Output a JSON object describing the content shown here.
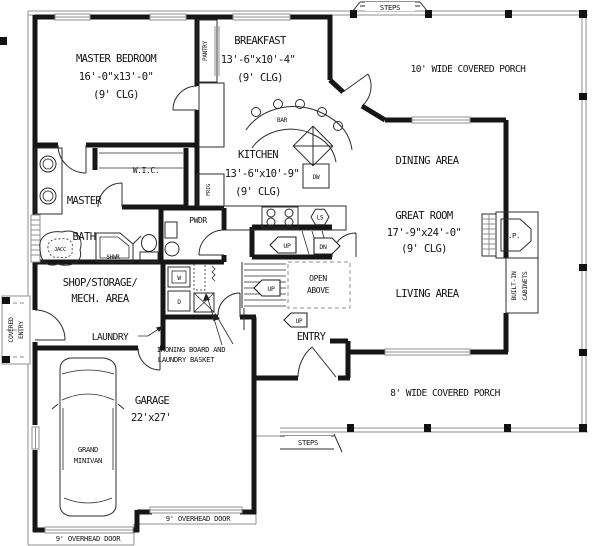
{
  "rooms": {
    "master_bedroom": {
      "name": "MASTER BEDROOM",
      "dims": "16'-0\"x13'-0\"",
      "ceiling": "(9' CLG)"
    },
    "breakfast": {
      "name": "BREAKFAST",
      "dims": "13'-6\"x10'-4\"",
      "ceiling": "(9' CLG)"
    },
    "kitchen": {
      "name": "KITCHEN",
      "dims": "13'-6\"x10'-9\"",
      "ceiling": "(9' CLG)"
    },
    "great_room": {
      "name": "GREAT ROOM",
      "dims": "17'-9\"x24'-0\"",
      "ceiling": "(9' CLG)"
    },
    "dining": {
      "name": "DINING AREA"
    },
    "living": {
      "name": "LIVING AREA"
    },
    "master_bath": {
      "line1": "MASTER",
      "line2": "BATH"
    },
    "wic": {
      "name": "W.I.C."
    },
    "powder": {
      "name": "PWDR"
    },
    "shop": {
      "line1": "SHOP/STORAGE/",
      "line2": "MECH. AREA"
    },
    "laundry": {
      "name": "LAUNDRY"
    },
    "entry": {
      "name": "ENTRY"
    },
    "garage": {
      "name": "GARAGE",
      "dims": "22'x27'"
    }
  },
  "porches": {
    "top": "10' WIDE COVERED PORCH",
    "bottom": "8' WIDE COVERED PORCH",
    "covered_entry_line1": "COVERED",
    "covered_entry_line2": "ENTRY"
  },
  "stairs": {
    "up": "UP",
    "dn": "DN",
    "open_above_line1": "OPEN",
    "open_above_line2": "ABOVE"
  },
  "labels": {
    "steps": "STEPS",
    "pantry": "PANTRY",
    "bar": "BAR",
    "frig": "FRIG",
    "dw": "DW",
    "ls": "LS",
    "fp": "F.P.",
    "built_in_line1": "BUILT-IN",
    "built_in_line2": "CABINETS",
    "washer": "W",
    "dryer": "D",
    "jacuzzi": "JACC",
    "shower": "SHWR",
    "ironing_line1": "IRONING BOARD AND",
    "ironing_line2": "LAUNDRY BASKET",
    "overhead_door_left": "9' OVERHEAD DOOR",
    "overhead_door_right": "9' OVERHEAD DOOR",
    "van_line1": "GRAND",
    "van_line2": "MINIVAN"
  },
  "colors": {
    "ink": "#161616",
    "line": "#8f8f8f",
    "background": "#ffffff"
  }
}
